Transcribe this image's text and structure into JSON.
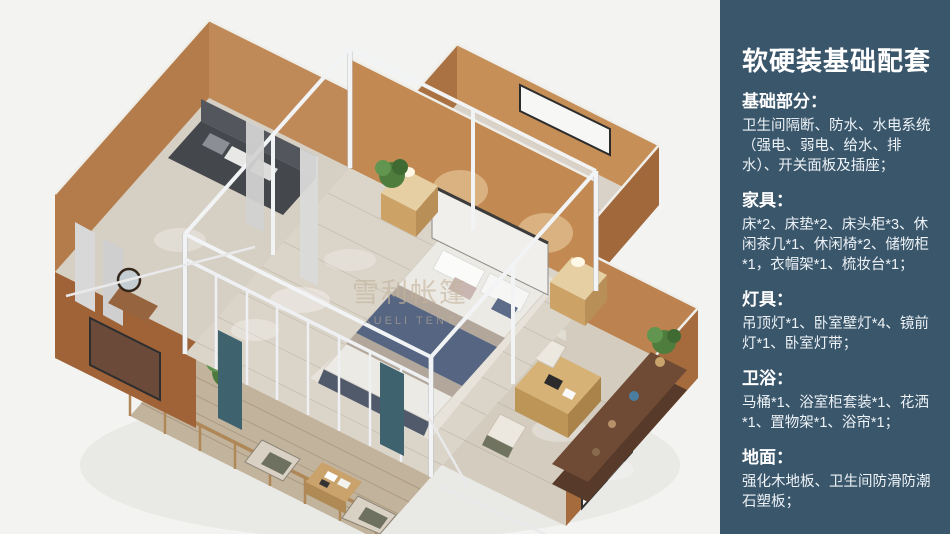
{
  "sidebar": {
    "title": "软硬装基础配套",
    "sections": [
      {
        "heading": "基础部分：",
        "body": "卫生间隔断、防水、水电系统（强电、弱电、给水、排水）、开关面板及插座；"
      },
      {
        "heading": "家具：",
        "body": "床*2、床垫*2、床头柜*3、休闲茶几*1、休闲椅*2、储物柜*1，衣帽架*1、梳妆台*1；"
      },
      {
        "heading": "灯具：",
        "body": "吊顶灯*1、卧室壁灯*4、镜前灯*1、卧室灯带；"
      },
      {
        "heading": "卫浴：",
        "body": "马桶*1、浴室柜套装*1、花洒*1、置物架*1、浴帘*1；"
      },
      {
        "heading": "地面：",
        "body": "强化木地板、卫生间防滑防潮石塑板；"
      }
    ]
  },
  "render": {
    "watermark_cn": "雪利帐篷",
    "watermark_en": "XUELI TENT",
    "subject": "3D isometric floor plan of a glamping tent house with bedroom, lounge wing, bathroom wing, study wing and front deck"
  },
  "colors": {
    "sidebar_bg": "#3a566b",
    "canvas_bg": "#f3f3f1",
    "wall_tan": "#c08a58",
    "wall_tan_shaded": "#a56b3d",
    "frame_white": "#f1f3f5",
    "floor_wood": "#dad4c9",
    "deck_wood": "#c2b39d",
    "drape_teal": "#3f626f",
    "plant_green": "#4e7d3e",
    "bed_blanket_blue": "#566581",
    "text_white": "#ffffff"
  }
}
